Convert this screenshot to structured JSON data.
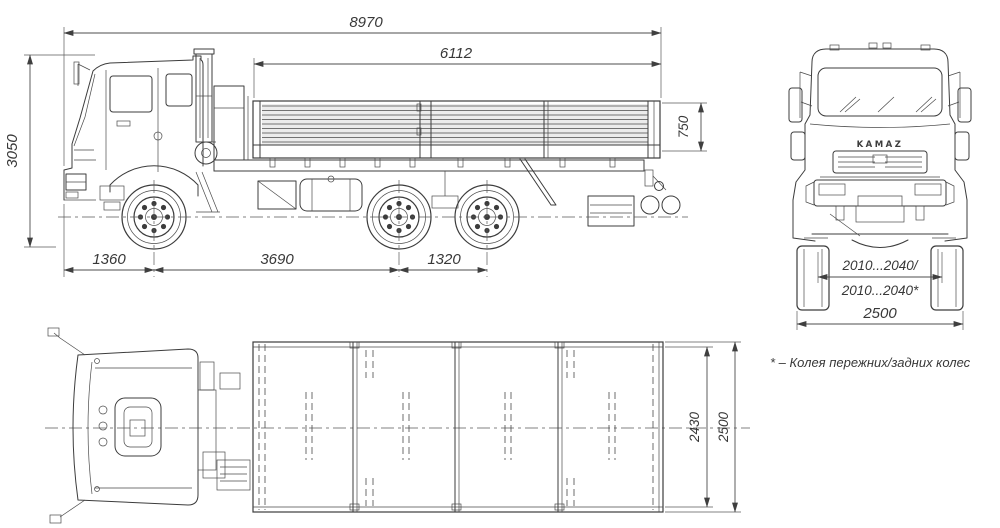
{
  "meta": {
    "subject": "KAMAZ 6x4 flatbed truck dimensional outline drawing"
  },
  "side_view": {
    "label": "side view",
    "dims": {
      "overall_length": "8970",
      "platform_length": "6112",
      "overall_height": "3050",
      "board_height": "750",
      "front_overhang": "1360",
      "wheelbase": "3690",
      "rear_bogie_base": "1320"
    }
  },
  "front_view": {
    "label": "front view",
    "grille_brand": "KAMAZ",
    "dims": {
      "wheel_track_line1": "2010...2040/",
      "wheel_track_line2": "2010...2040*",
      "overall_width": "2500"
    }
  },
  "top_view": {
    "label": "top view",
    "dims": {
      "platform_inner_width": "2430",
      "platform_outer_width": "2500"
    }
  },
  "footnote": "* – Колея пережних/задних колес",
  "colors": {
    "background": "#ffffff",
    "line": "#3c3c3c",
    "dimension": "#4c4c4c",
    "text": "#383838"
  }
}
